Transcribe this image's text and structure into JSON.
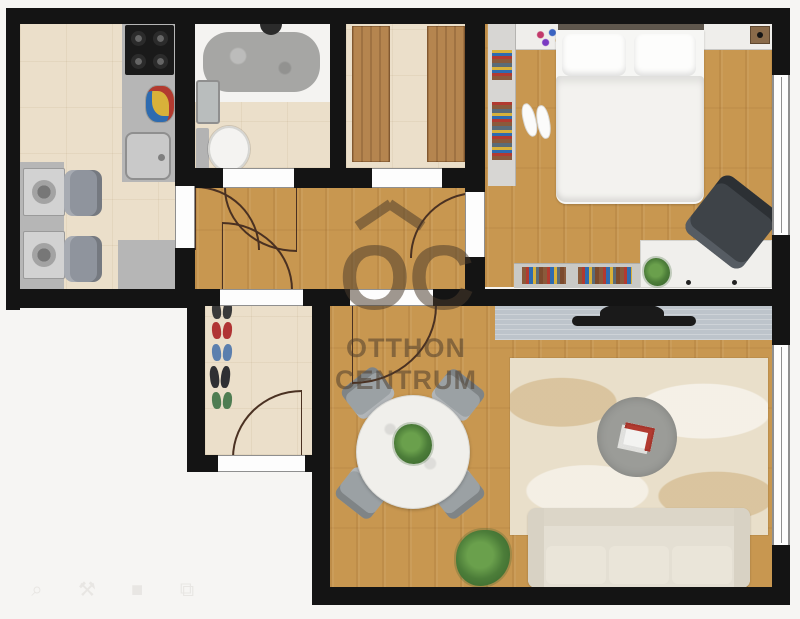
{
  "watermark": {
    "logo_text": "OC",
    "line1": "OTTHON",
    "line2": "CENTRUM"
  },
  "toolbar": {
    "icons": [
      {
        "name": "zoom-icon",
        "glyph": "⌕"
      },
      {
        "name": "tools-icon",
        "glyph": "⚒"
      },
      {
        "name": "stop-square-icon",
        "glyph": "■"
      },
      {
        "name": "layers-icon",
        "glyph": "⧉"
      }
    ]
  },
  "palette": {
    "bg": "#f6f5f3",
    "wall": "#141414",
    "wood": "#c89750",
    "tile": "#ebdfca",
    "counter": "#b6b6b6",
    "appliance": "#d2d2d2",
    "chair": "#8f949d",
    "wardrobe": "#b5854f",
    "shelf": "#efeeeb",
    "console": "#bdc4cb",
    "tv": "#1a1a1a",
    "rug": "#e9dfca",
    "sofa": "#e4dfd3",
    "table": "#f0efeb",
    "plant": "#4c7d39",
    "watermark": "#4a3b2b"
  },
  "floorplan": {
    "rooms": [
      {
        "id": "kitchen",
        "furniture": [
          "counter",
          "washing-machine",
          "washing-machine",
          "armchair",
          "armchair",
          "gas-hob",
          "fruit-bowl",
          "sink"
        ]
      },
      {
        "id": "bathroom",
        "furniture": [
          "bathtub",
          "washbasin",
          "toilet"
        ]
      },
      {
        "id": "wardrobe-room",
        "furniture": [
          "wardrobe",
          "wardrobe"
        ]
      },
      {
        "id": "bedroom",
        "furniture": [
          "double-bed",
          "nightstand-shelf",
          "bookshelf",
          "slippers",
          "desk",
          "office-chair",
          "low-bookshelf",
          "plant"
        ]
      },
      {
        "id": "hallway",
        "furniture": []
      },
      {
        "id": "entry-hall",
        "furniture": [
          "shoes",
          "shoes",
          "shoes",
          "shoes",
          "shoes"
        ]
      },
      {
        "id": "living-room",
        "furniture": [
          "tv-console",
          "tv",
          "rug",
          "coffee-table",
          "sofa",
          "dining-table",
          "dining-chair",
          "dining-chair",
          "dining-chair",
          "dining-chair",
          "plant",
          "plant"
        ]
      }
    ]
  }
}
